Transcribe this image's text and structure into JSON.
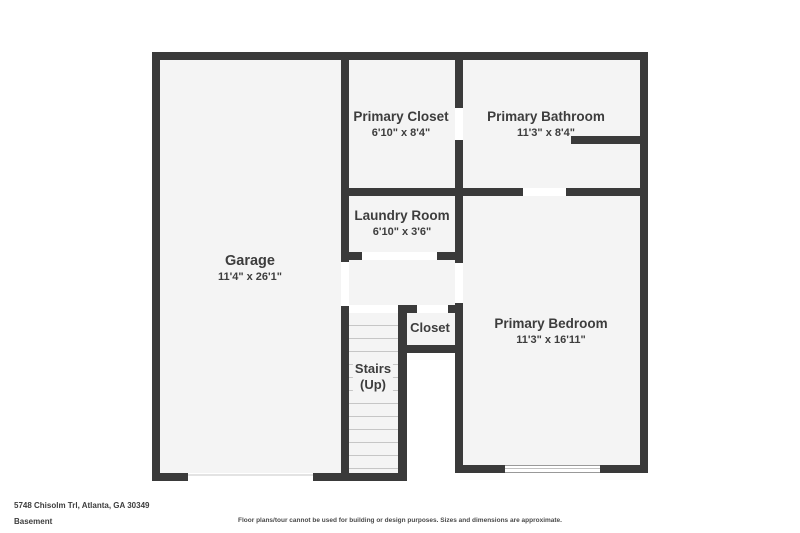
{
  "floor_plan": {
    "address": "5748 Chisolm Trl, Atlanta, GA 30349",
    "level": "Basement",
    "disclaimer": "Floor plans/tour cannot be used for building or design purposes. Sizes and dimensions are approximate.",
    "colors": {
      "wall": "#3a3a3a",
      "room_fill": "#f4f4f4",
      "background": "#ffffff",
      "label_text": "#3d3d3d",
      "stair_tread_line": "#c6c6c6"
    },
    "rooms": [
      {
        "name": "Garage",
        "dims": "11'4\" x 26'1\""
      },
      {
        "name": "Primary Closet",
        "dims": "6'10\" x 8'4\""
      },
      {
        "name": "Primary Bathroom",
        "dims": "11'3\" x 8'4\""
      },
      {
        "name": "Laundry Room",
        "dims": "6'10\" x 3'6\""
      },
      {
        "name": "Closet",
        "dims": ""
      },
      {
        "name": "Stairs",
        "dims": "(Up)"
      },
      {
        "name": "Primary Bedroom",
        "dims": "11'3\" x 16'11\""
      }
    ],
    "features": [
      "garage-door-opening-bottom",
      "window-primary-bedroom-bottom",
      "stairs-up-12-treads"
    ]
  }
}
